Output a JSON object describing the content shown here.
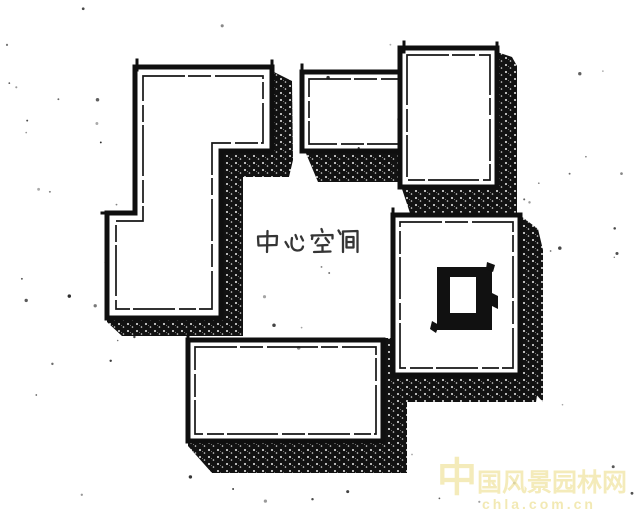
{
  "figure": {
    "kind": "hand-drawn concept plan sketch",
    "center_label": "中心空间",
    "blocks": [
      {
        "name": "upper-left-l-shaped-block"
      },
      {
        "name": "upper-right-stepped-block"
      },
      {
        "name": "right-courtyard-block-with-inner-square"
      },
      {
        "name": "bottom-rectangular-block"
      }
    ]
  },
  "watermark": {
    "site_name": "中国风景园林网",
    "site_url": "chla.com.cn"
  },
  "colors": {
    "ink": "#111111",
    "paper": "#ffffff",
    "watermark_text": "#f2e7aa"
  }
}
